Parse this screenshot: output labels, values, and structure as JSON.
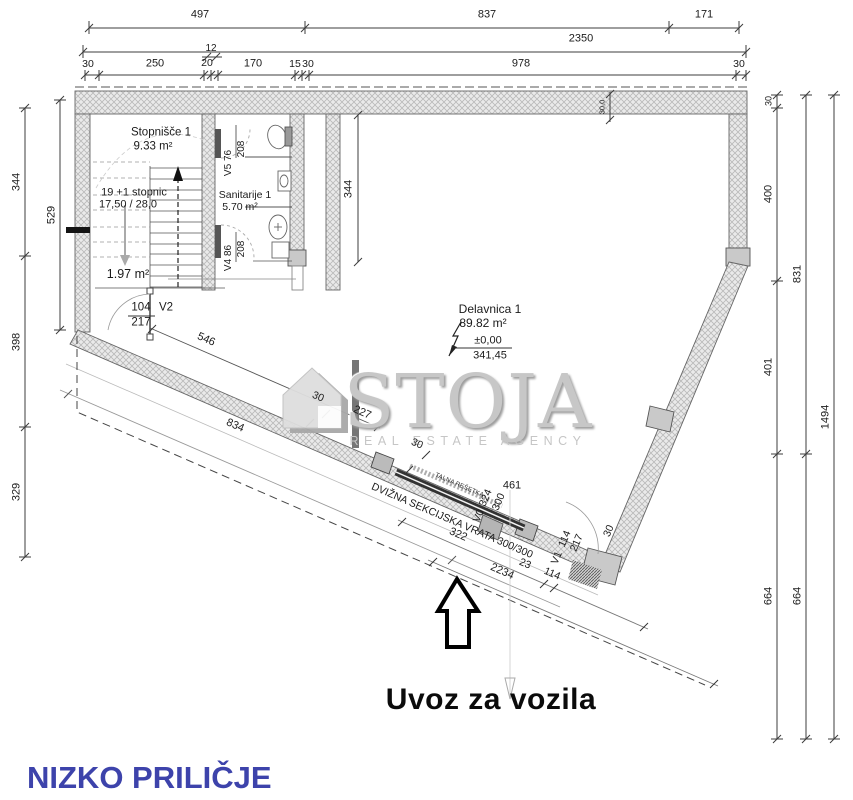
{
  "footer_title": "NIZKO PRILIČJE",
  "entrance_arrow_label": "Uvoz za vozila",
  "watermark": {
    "brand": "STOJA",
    "tagline": "REAL ESTATE AGENCY"
  },
  "colors": {
    "accent_blue": "#3d43ab",
    "line": "#4a4a4a",
    "wall_fill": "#eaeaea",
    "watermark_gray": "#c7c7c7"
  },
  "dimensions": {
    "top": {
      "row1": [
        "497",
        "837",
        "171"
      ],
      "overall": "2350",
      "small": "12",
      "row3": [
        "30",
        "250",
        "20",
        "170",
        "15",
        "30",
        "978",
        "30"
      ]
    },
    "left": {
      "outer": [
        "344",
        "398",
        "329"
      ],
      "inner": "529"
    },
    "right": {
      "inner": [
        "30",
        "400",
        "401",
        "664"
      ],
      "middle": [
        "831",
        "664"
      ],
      "overall": "1494"
    },
    "interior": {
      "hall_depth": "344",
      "wall_thickness": "30,0"
    },
    "diagonal": {
      "d546": "546",
      "d834": "834",
      "d227": "227",
      "d322": "322",
      "d2234": "2234",
      "d23": "23",
      "d114": "114",
      "d461": "461",
      "wall30": [
        "30",
        "30",
        "30"
      ]
    }
  },
  "rooms": {
    "stairs": {
      "name": "Stopnišče 1",
      "area": "9.33 m²",
      "steps": "19 +1 stopnic",
      "riser": "17,50 / 28,0",
      "under_area": "1.97 m²"
    },
    "sanitary": {
      "name": "Sanitarije 1",
      "area": "5.70 m²"
    },
    "workshop": {
      "name": "Delavnica 1",
      "area": "89.82 m²",
      "level": "±0,00",
      "elevation": "341,45"
    }
  },
  "doors": {
    "v2": {
      "code": "V2",
      "width": "104",
      "height": "217"
    },
    "v5": {
      "code": "V5 76",
      "height": "208"
    },
    "v4": {
      "code": "V4 86",
      "height": "208"
    },
    "v0": {
      "code": "V0",
      "width": "324",
      "height": "300"
    },
    "v1": {
      "code": "V1",
      "width": "114",
      "height": "217"
    }
  },
  "annotations": {
    "garage_door": "DVIŽNA SEKCIJSKA VRATA 300/300",
    "floor_grate": "TALNA REŠETKA"
  }
}
